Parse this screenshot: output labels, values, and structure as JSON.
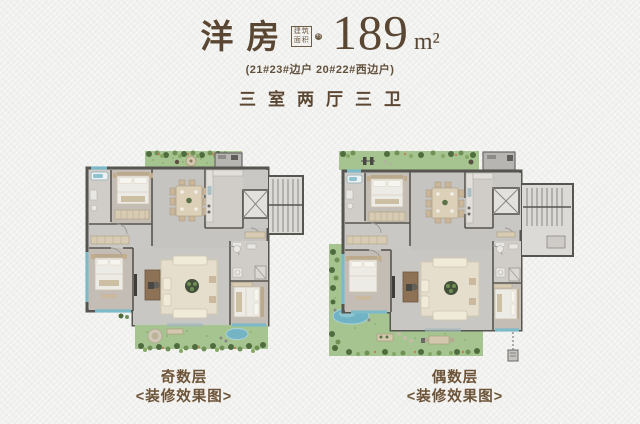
{
  "header": {
    "title": "洋房",
    "seal": {
      "top": "建筑",
      "bottom": "面积",
      "badge": "约"
    },
    "area_value": "189",
    "area_unit": "m²",
    "subtitle": "(21#23#边户 20#22#西边户)",
    "spec": "三室两厅三卫"
  },
  "plans": [
    {
      "name": "奇数层",
      "caption": "<装修效果图>"
    },
    {
      "name": "偶数层",
      "caption": "<装修效果图>"
    }
  ],
  "colors": {
    "accent_brown": "#5a4733",
    "caption_brown": "#6d5438",
    "wall_gray": "#57554f",
    "floor_gray": "#c6c4c0",
    "grass_green": "#a6c490",
    "water_teal": "#74b4c4",
    "furniture_beige": "#d8cbb3",
    "background": "#f1f1ef"
  }
}
